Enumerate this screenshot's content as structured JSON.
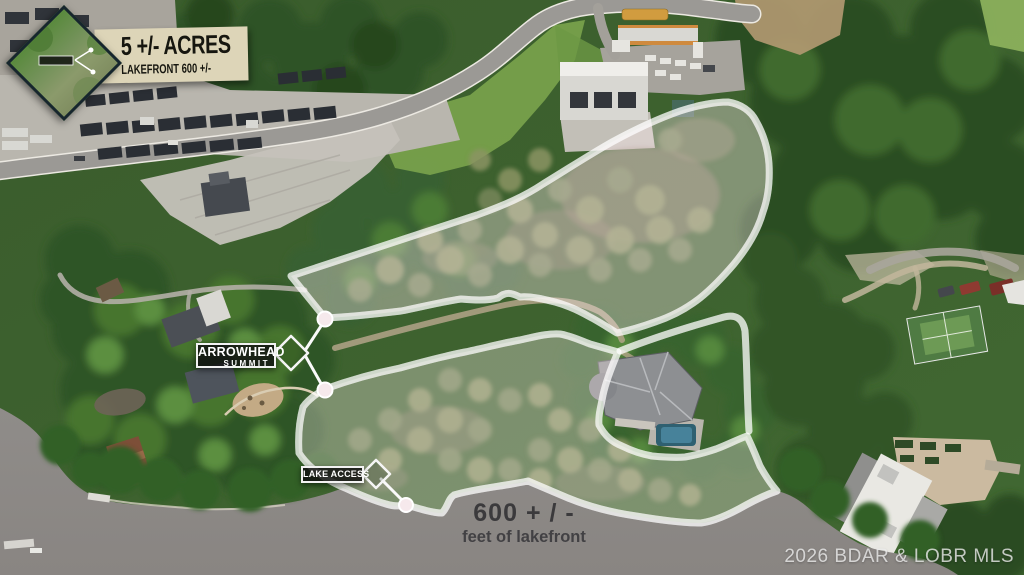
{
  "badge": {
    "acreage": "5 +/- ACRES",
    "subtitle": "LAKEFRONT 600 +/-"
  },
  "map_labels": {
    "arrowhead_line1": "ARROWHEAD",
    "arrowhead_line2": "SUMMIT",
    "lake_access": "LAKE ACCESS",
    "lakefront_value": "600 + / -",
    "lakefront_caption": "feet of lakefront"
  },
  "watermark": "2026 BDAR & LOBR MLS",
  "colors": {
    "boundary_line": "#f4d4d9",
    "boundary_casing": "#ffffff",
    "parcel_tint": "rgba(255,236,238,0.20)",
    "banner_bg": "#ddd5b8",
    "banner_text": "#16160f",
    "label_box_bg": "rgba(17,17,17,0.84)",
    "label_box_border": "#f2f2f2",
    "lakefront_text": "#3b3a3c",
    "water": "#8e8b88",
    "watermark_text": "rgba(240,240,240,0.78)"
  }
}
